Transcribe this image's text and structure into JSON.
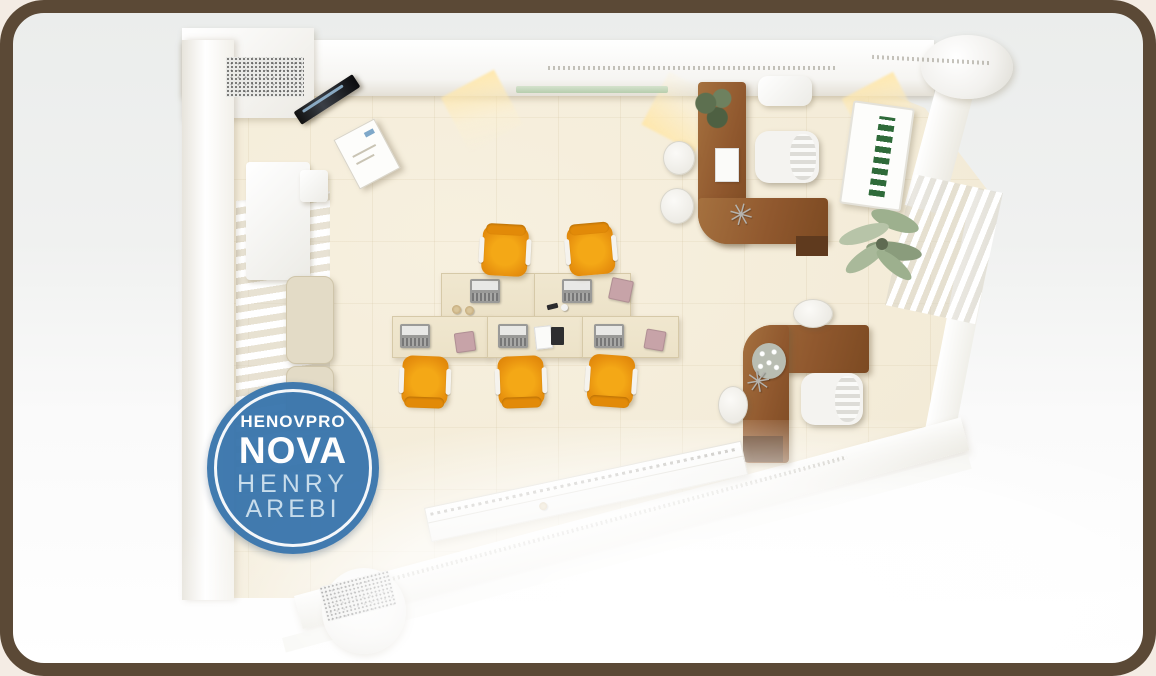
{
  "scene": {
    "description": "Top-down 3D render of an open-plan office floor plan in a picture frame",
    "workstation_desks": 5,
    "orange_task_chairs": 5,
    "executive_l_desks": 2,
    "executive_chairs": 2,
    "guest_chairs": 5,
    "plants": 3,
    "sofas": 1
  },
  "watermark_logo": {
    "line1": "HENOVPRO",
    "line2": "NOVA",
    "line3": "HENRY",
    "line4": "AREBI"
  },
  "colors": {
    "frame_brown": "#5b4936",
    "matte_light": "#f0f1f0",
    "floor_cream": "#f3ebd7",
    "wall_white": "#ffffff",
    "desk_cream": "#ece2c8",
    "desk_edge": "#d6c9a8",
    "chair_orange": "#e8920f",
    "chair_orange_light": "#f4a816",
    "chair_orange_deep": "#d97f06",
    "wood": "#90582e",
    "wood_dark": "#5f3a1e",
    "sofa_beige": "#e3dbc6",
    "book_green": "#2f6b3a",
    "plant_green": "#9db08e",
    "plant_dark": "#5d7050",
    "logo_blue": "#3a76ad",
    "logo_text_light": "#c6dcec",
    "granite_gray": "#bdbdb9",
    "glass_green": "#aec9a6",
    "warm_light": "#ffe7aa"
  }
}
